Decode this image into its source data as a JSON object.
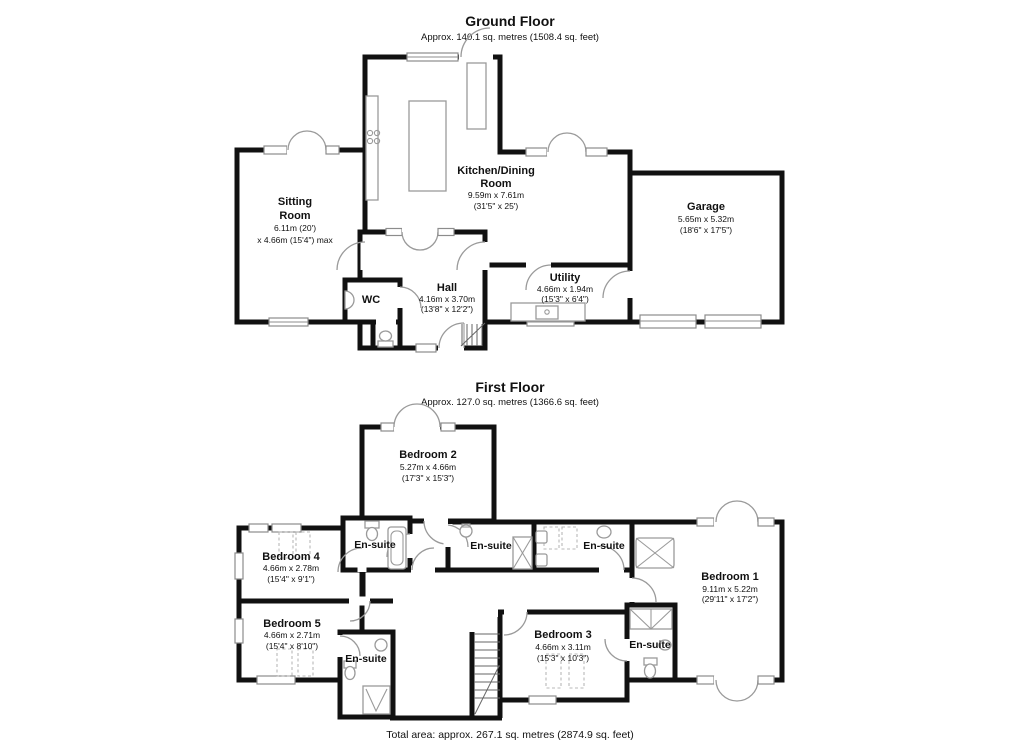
{
  "gf": {
    "title": "Ground Floor",
    "subtitle": "Approx. 140.1 sq. metres (1508.4 sq. feet)",
    "rooms": {
      "sitting": {
        "line1": "Sitting",
        "line2": "Room",
        "dim1": "6.11m (20')",
        "dim2": "x 4.66m (15'4\") max"
      },
      "kitchen": {
        "line1": "Kitchen/Dining",
        "line2": "Room",
        "dim1": "9.59m x 7.61m",
        "dim2": "(31'5\" x 25')"
      },
      "garage": {
        "name": "Garage",
        "dim1": "5.65m x 5.32m",
        "dim2": "(18'6\" x 17'5\")"
      },
      "hall": {
        "name": "Hall",
        "dim1": "4.16m x 3.70m",
        "dim2": "(13'8\" x 12'2\")"
      },
      "utility": {
        "name": "Utility",
        "dim1": "4.66m x 1.94m",
        "dim2": "(15'3\" x 6'4\")"
      },
      "wc": {
        "name": "WC"
      }
    }
  },
  "ff": {
    "title": "First Floor",
    "subtitle": "Approx. 127.0 sq. metres (1366.6 sq. feet)",
    "ensuite_label": "En-suite",
    "rooms": {
      "bed1": {
        "name": "Bedroom 1",
        "dim1": "9.11m x 5.22m",
        "dim2": "(29'11\" x 17'2\")"
      },
      "bed2": {
        "name": "Bedroom 2",
        "dim1": "5.27m x 4.66m",
        "dim2": "(17'3\" x 15'3\")"
      },
      "bed3": {
        "name": "Bedroom 3",
        "dim1": "4.66m x 3.11m",
        "dim2": "(15'3\" x 10'3\")"
      },
      "bed4": {
        "name": "Bedroom 4",
        "dim1": "4.66m x 2.78m",
        "dim2": "(15'4\" x 9'1\")"
      },
      "bed5": {
        "name": "Bedroom 5",
        "dim1": "4.66m x 2.71m",
        "dim2": "(15'4\" x 8'10\")"
      }
    }
  },
  "footer": {
    "total_area": "Total area: approx. 267.1 sq. metres (2874.9 sq. feet)"
  },
  "colors": {
    "wall": "#111111",
    "fixture": "#9a9a9a",
    "window": "#8c8c8c"
  }
}
